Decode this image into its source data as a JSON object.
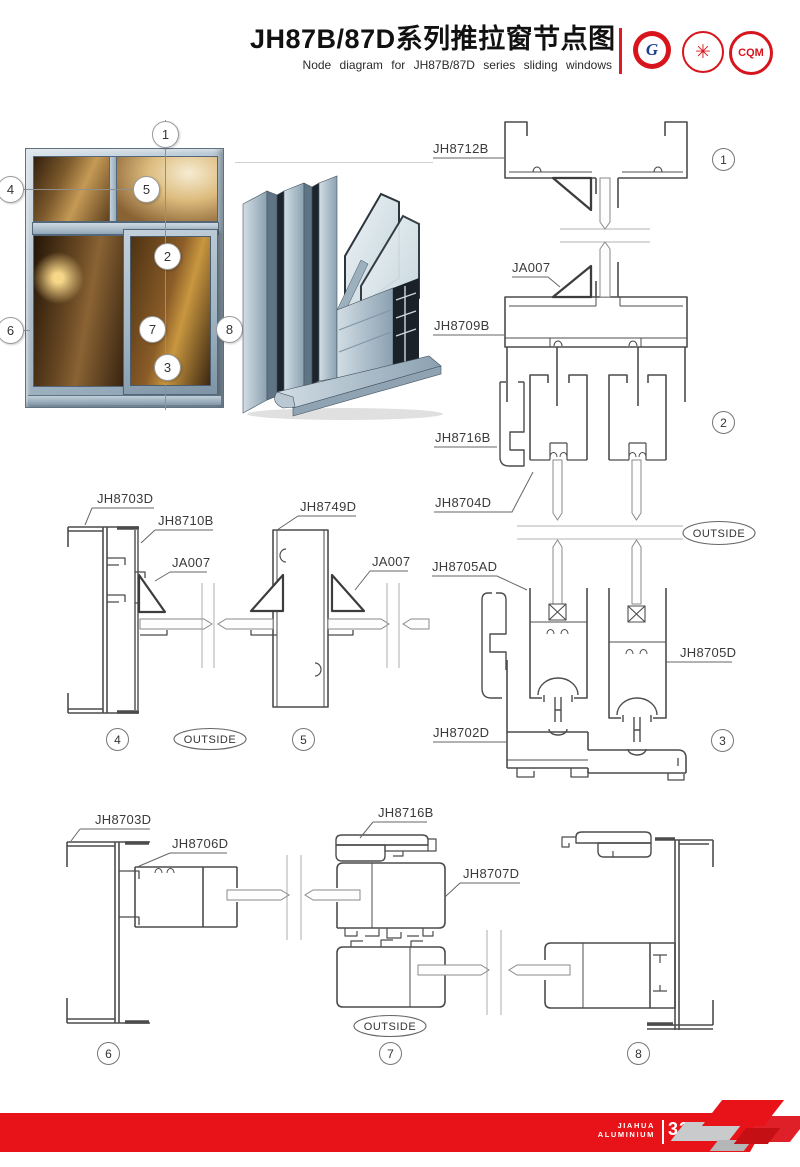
{
  "header": {
    "title": "JH87B/87D系列推拉窗节点图",
    "subtitle": "Node diagram for JH87B/87D series sliding windows",
    "logos": [
      {
        "name": "gb-certification-logo",
        "text": "G"
      },
      {
        "name": "star-seal-logo",
        "text": "✳"
      },
      {
        "name": "cqm-logo",
        "text": "CQM"
      }
    ]
  },
  "callouts": [
    "1",
    "2",
    "3",
    "4",
    "5",
    "6",
    "7",
    "8"
  ],
  "parts": {
    "jh8712b": "JH8712B",
    "ja007": "JA007",
    "jh8709b": "JH8709B",
    "jh8716b": "JH8716B",
    "jh8704d": "JH8704D",
    "jh8705ad": "JH8705AD",
    "jh8705d": "JH8705D",
    "jh8702d": "JH8702D",
    "jh8703d": "JH8703D",
    "jh8710b": "JH8710B",
    "jh8749d": "JH8749D",
    "jh8706d": "JH8706D",
    "jh8707d": "JH8707D"
  },
  "misc": {
    "outside": "OUTSIDE"
  },
  "footer": {
    "brand_line1": "JIAHUA",
    "brand_line2": "ALUMINIUM",
    "page_number": "33"
  },
  "colors": {
    "accent_red": "#e81318",
    "line_gray": "#4c4c4c",
    "frame_blue": "#a9bcca"
  }
}
